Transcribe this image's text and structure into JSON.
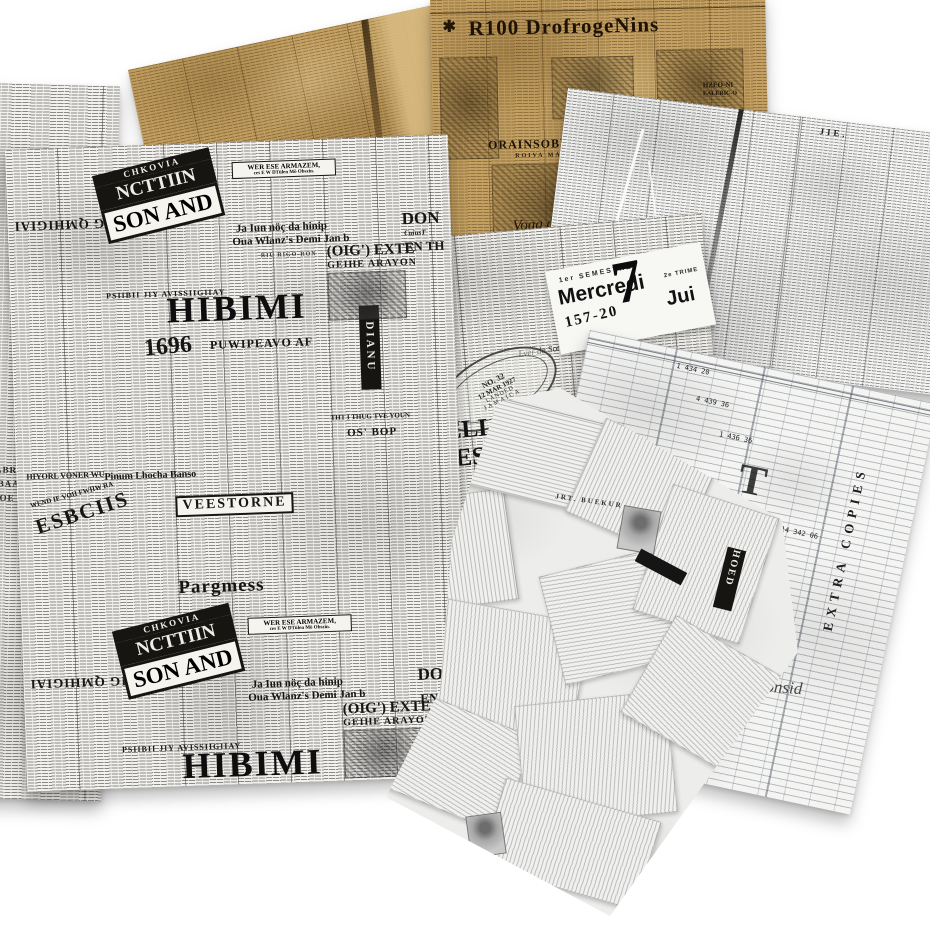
{
  "palette": {
    "sepia": "#c4a162",
    "sepia_deep": "#8a6a33",
    "paper": "#f3f2ef",
    "ink": "#191919",
    "gray_ink": "#4a4a4a"
  },
  "sheets": {
    "left_edge_sheet": {
      "fragment_1": "1 ABRR",
      "fragment_2": "O BAAB",
      "fragment_3": "3OOE"
    },
    "sepia_center": {
      "masthead": "R100 DrofrogeNins",
      "star": "✱",
      "script_line": "Voag con fb and Me cuen...",
      "section_head": "ORAINSOBLEDNG",
      "section_sub": "ROIVA MAINO",
      "fragment_top_right": "HZEO-NI",
      "fragment_top_right2": "EALERIC-O"
    },
    "gray_top_right": {
      "column_header": "JIE."
    },
    "french_sheet": {
      "headline_top": "ELLET (I",
      "headline_bottom": "RES),",
      "subhead": "HDtENT OYERS",
      "cursive_note": "Lver da Sotval",
      "stamp_no": "NO. 32",
      "stamp_date": "12 MAR 1927",
      "stamp_landed": "LANDED",
      "stamp_place": "JAMAICA"
    },
    "calendar_card": {
      "semester": "1er SEMESTRE",
      "day_name": "Mercredi",
      "week_numbers": "157-20",
      "day_number": "7",
      "trimester": "2e TRIME",
      "month": "Jui"
    },
    "ledger_sheet": {
      "vertical_label": "EXTRA COPIES",
      "initial": "T",
      "signature": "Tinhas Consid",
      "numbers": [
        "1 434 20",
        "4 439 36",
        "1 436 36",
        "14 342 06"
      ]
    },
    "crumple_sheet": {
      "black_label": "HOED",
      "tiny_caps": "JRT. BUEKUR"
    },
    "left_collage": {
      "chkovia": "CHKOVIA",
      "ncttiin": "NCTTIIN",
      "son_and": "SON AND",
      "armazem_line1": "WER ESE ARMAZEM,",
      "armazem_line2": "ces E W DTülen Mö Obszin.",
      "ja_iun_line1": "Ja Iun nöç da hinip",
      "ja_iun_line2": "Oua Wlanz's Demi Jan b",
      "riu_rigoron": "RIU RIGO-RON",
      "psiibii": "PSIIBII JIY AVISSIIGIIAY",
      "masthead": "HIBIMI",
      "masthead_sub": "PUWIPEAVO AF",
      "year": "1696",
      "vertical_label": "DIANU",
      "don": "DON",
      "don_sub": "CuiusT",
      "en_th": "EN TH",
      "exte": "(OIG') EXTE",
      "exte_sub": "GEIHE ARAYON",
      "tht_line": "THT I THUG TVE YOUN",
      "os_bop": "OS' BOP",
      "pinum": "Pinum Lhocha Banso",
      "hiyorl": "HIYORL VONER WU",
      "wend": "WEND IE VOII FWIIW RA",
      "esbcus": "ESBCIIS",
      "veestorne": "VEESTORNE",
      "pargmess": "Pargmess",
      "upside_down": "MBIG QMHIGIAI"
    }
  }
}
